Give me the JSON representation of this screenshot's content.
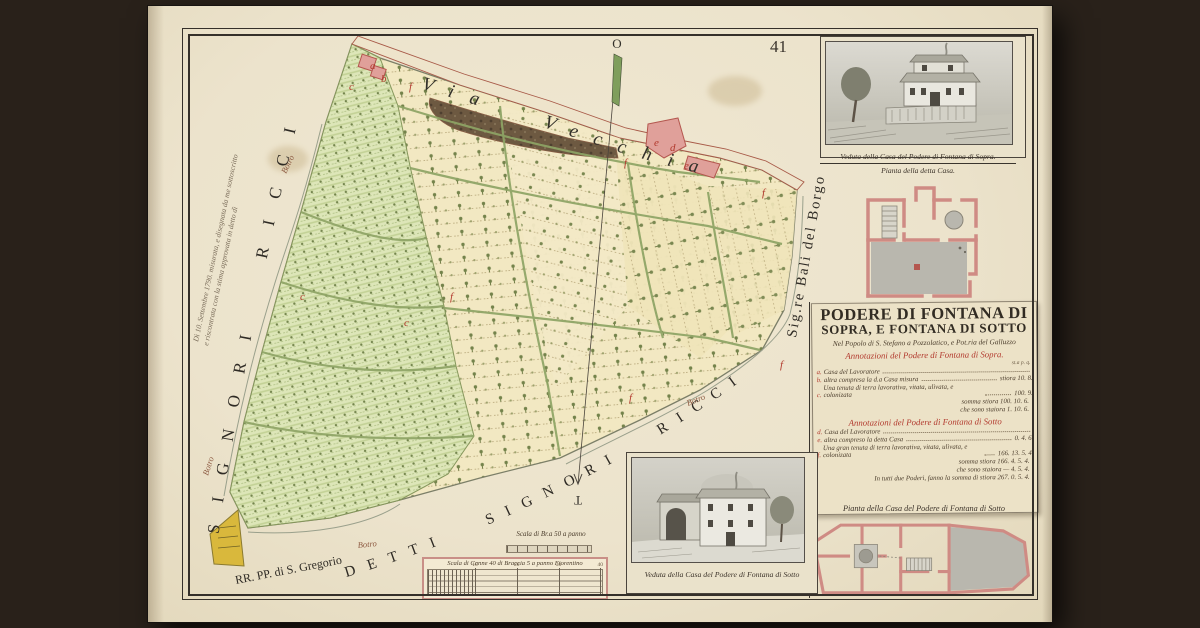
{
  "artwork": {
    "page_number": "41",
    "title_line1": "PODERE DI FONTANA DI",
    "title_line2": "SOPRA, E FONTANA DI SOTTO",
    "subtitle": "Nel Popolo di S. Stefano a Pozzolatico, e Pot.ria del Galluzzo",
    "marginal_note_1": "Dì 10. Settembre 1790. misurata, e disegnata da me sottoscritto",
    "marginal_note_2": "e riscontrata con la stima approvata in detto dì"
  },
  "map": {
    "road_label": "Via Vecchia",
    "stream_label": "Botro",
    "compass_top": "O",
    "compass_bottom": "T",
    "boundary_left": "SIGNORI RICCI",
    "boundary_bottom": "DETTI SIGNORI RICCI",
    "boundary_bottom_left": "RR. PP. di S. Gregorio",
    "boundary_right": "Sig.re Bali del Borgo",
    "letters": [
      {
        "ch": "a"
      },
      {
        "ch": "b"
      },
      {
        "ch": "c"
      },
      {
        "ch": "f"
      },
      {
        "ch": "f"
      },
      {
        "ch": "e"
      },
      {
        "ch": "d"
      },
      {
        "ch": "e"
      },
      {
        "ch": "f"
      },
      {
        "ch": "f"
      },
      {
        "ch": "c"
      },
      {
        "ch": "f"
      },
      {
        "ch": "f"
      },
      {
        "ch": "c"
      }
    ]
  },
  "panels": {
    "veduta_sopra_caption": "Veduta della Casa del Podere di Fontana di Sopra.",
    "pianta_sopra_caption": "Pianta della detta Casa.",
    "veduta_sotto_caption": "Veduta della Casa del Podere di Fontana di Sotto",
    "pianta_sotto_caption": "Pianta della Casa del Podere di Fontana di Sotto"
  },
  "annotations_sopra": {
    "heading": "Annotazioni del Podere di Fontana di Sopra.",
    "unit_header": "st.a  p.  q.",
    "items": [
      {
        "letter": "a.",
        "text": "Casa del Lavoratore",
        "value": ""
      },
      {
        "letter": "b.",
        "text": "altra compresa la d.a Casa misura",
        "value": "stiora 10. 8."
      },
      {
        "letter": "c.",
        "text": "Una tenuta di terra lavorativa, vitata, ulivata, e colonizata",
        "value": "100. 9."
      }
    ],
    "totals": [
      "somma stiora 100. 10. 6.",
      "che sono staiora 1. 10. 6."
    ]
  },
  "annotations_sotto": {
    "heading": "Annotazioni del Podere di Fontana di Sotto",
    "items": [
      {
        "letter": "d.",
        "text": "Casa del Lavoratore",
        "value": ""
      },
      {
        "letter": "e.",
        "text": "altra compreso la detta Casa",
        "value": "0. 4. 6."
      },
      {
        "letter": "f.",
        "text": "Una gran tenuta di terra lavorativa, vitata, ulivata, e colonizata",
        "value": "166. 13. 5. 4."
      }
    ],
    "totals": [
      "somma stiora 166. 4. 5. 4.",
      "che sono staiora — 4. 5. 4.",
      "In tutti due Poderi, fanno la somma di stiora 267. 0. 5. 4."
    ]
  },
  "scales": {
    "small": "Scala di Br.a 50 a panno",
    "large": "Scala di Canne 40 di Braccia 5 a panno Fiorentino",
    "large_numbers": [
      "10",
      "20",
      "30",
      "40"
    ]
  },
  "colors": {
    "paper": "#ece3cc",
    "field_yellow": "#f2e8c2",
    "field_green": "#dde6b8",
    "building_pink": "#e0a09a",
    "ink_red": "#b23a2e",
    "ink_brown": "#4b3d2c",
    "plan_pink": "#cf8b84"
  }
}
